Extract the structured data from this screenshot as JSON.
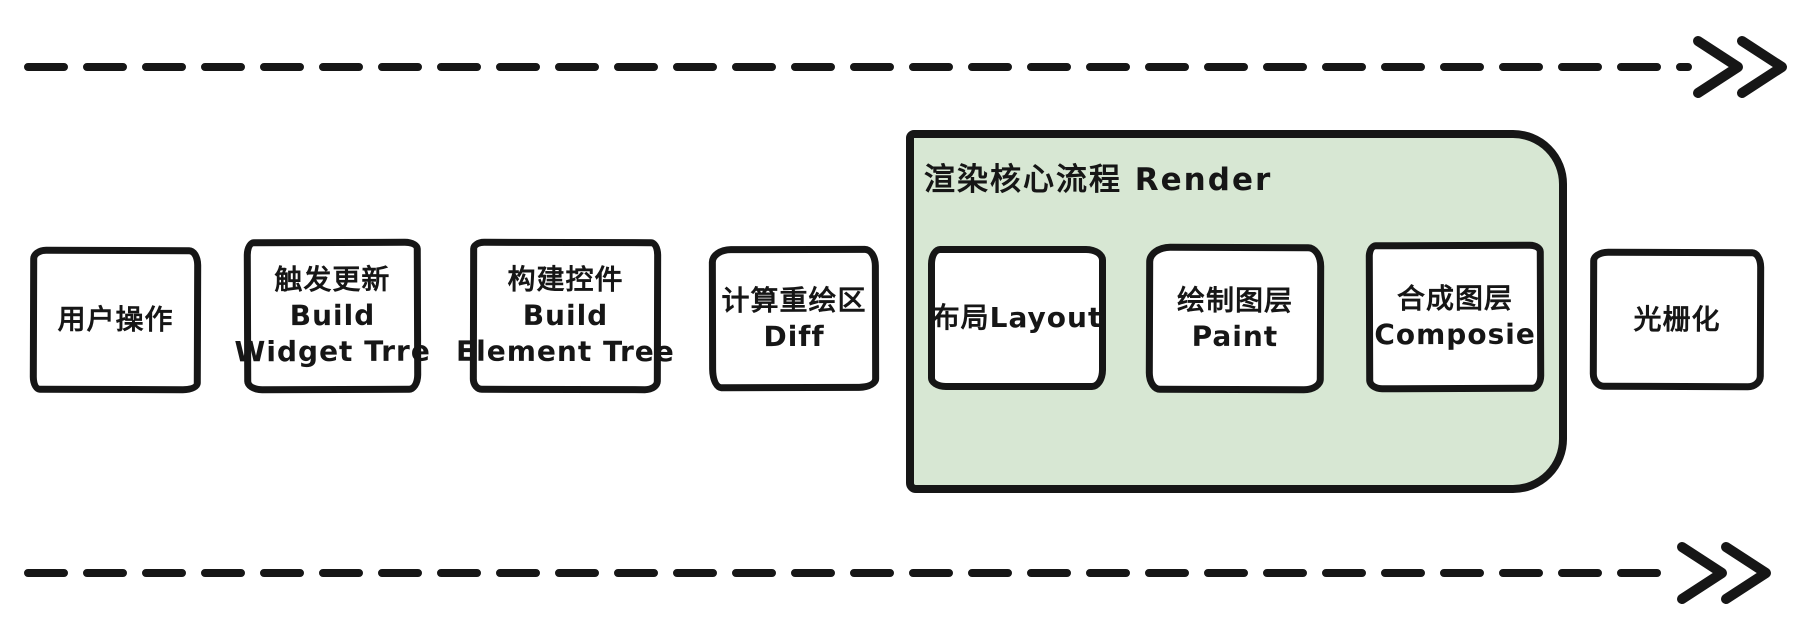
{
  "diagram": {
    "type": "flowchart",
    "direction": "left-to-right",
    "background": "#ffffff",
    "stroke_color": "#161616",
    "arrows": {
      "top": {
        "style": "dashed",
        "direction": "right",
        "head": "double-chevron"
      },
      "bottom": {
        "style": "dashed",
        "direction": "right",
        "head": "double-chevron"
      }
    },
    "group": {
      "id": "render",
      "label": "渲染核心流程 Render",
      "fill": "#d7e7d3"
    },
    "nodes": [
      {
        "id": "user-action",
        "lines": [
          "用户操作"
        ]
      },
      {
        "id": "trigger-update",
        "lines": [
          "触发更新",
          "Build",
          "Widget Trre"
        ]
      },
      {
        "id": "build-element-tree",
        "lines": [
          "构建控件",
          "Build",
          "Element Tree"
        ]
      },
      {
        "id": "diff",
        "lines": [
          "计算重绘区",
          "Diff"
        ]
      },
      {
        "id": "layout",
        "lines": [
          "布局Layout"
        ],
        "group": "render"
      },
      {
        "id": "paint",
        "lines": [
          "绘制图层",
          "Paint"
        ],
        "group": "render"
      },
      {
        "id": "composite",
        "lines": [
          "合成图层",
          "Composie"
        ],
        "group": "render"
      },
      {
        "id": "rasterize",
        "lines": [
          "光栅化"
        ]
      }
    ]
  }
}
